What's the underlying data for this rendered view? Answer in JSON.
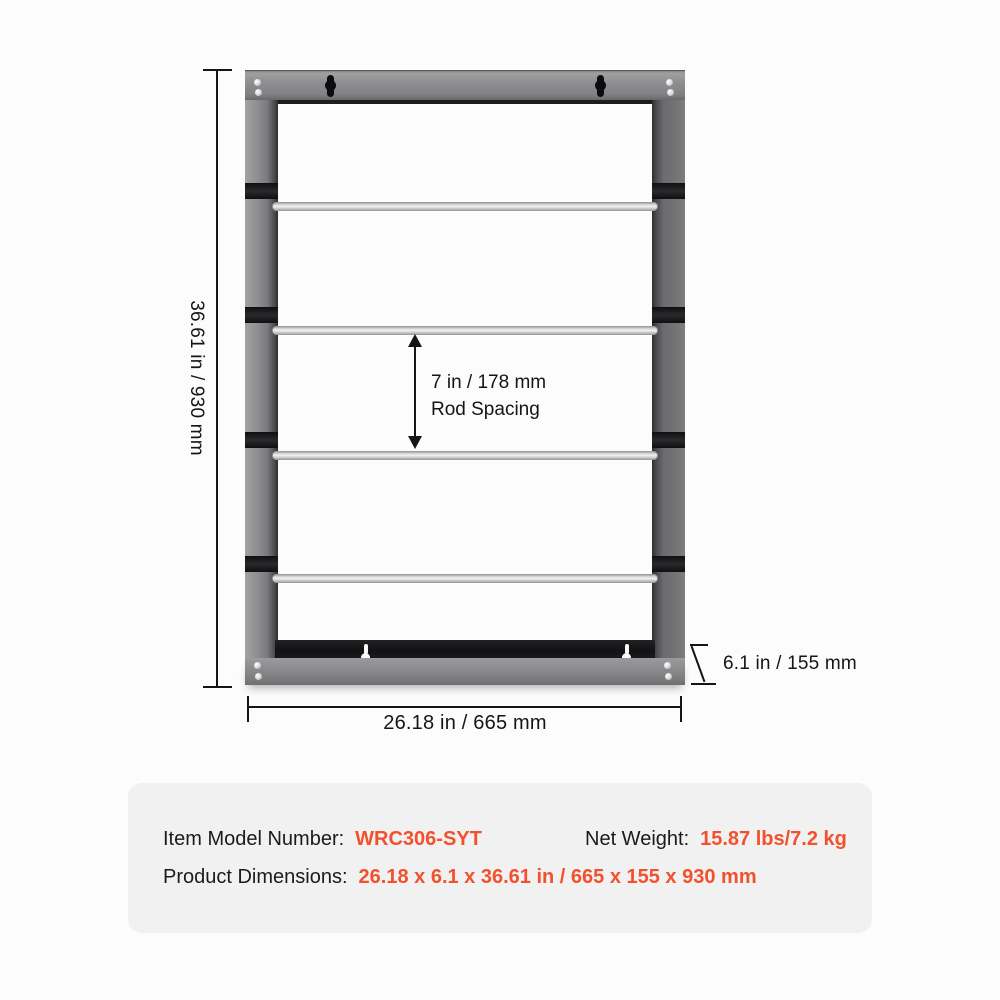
{
  "colors": {
    "accent": "#f2512d",
    "line": "#151515",
    "frame_gray": "#8d8d8f",
    "panel_gray": "#f1f1f2"
  },
  "diagram": {
    "height_label": "36.61 in / 930 mm",
    "width_label": "26.18 in / 665 mm",
    "depth_label": "6.1 in / 155 mm",
    "rod_spacing": {
      "line1": "7 in / 178 mm",
      "line2": "Rod Spacing"
    },
    "rod_count": 4
  },
  "info_box": {
    "model": {
      "label": "Item Model Number:",
      "value": "WRC306-SYT"
    },
    "net_weight": {
      "label": "Net Weight:",
      "value": "15.87 lbs/7.2 kg"
    },
    "product_dimensions": {
      "label": "Product Dimensions:",
      "value": "26.18 x 6.1 x 36.61 in / 665 x 155 x 930 mm"
    }
  }
}
